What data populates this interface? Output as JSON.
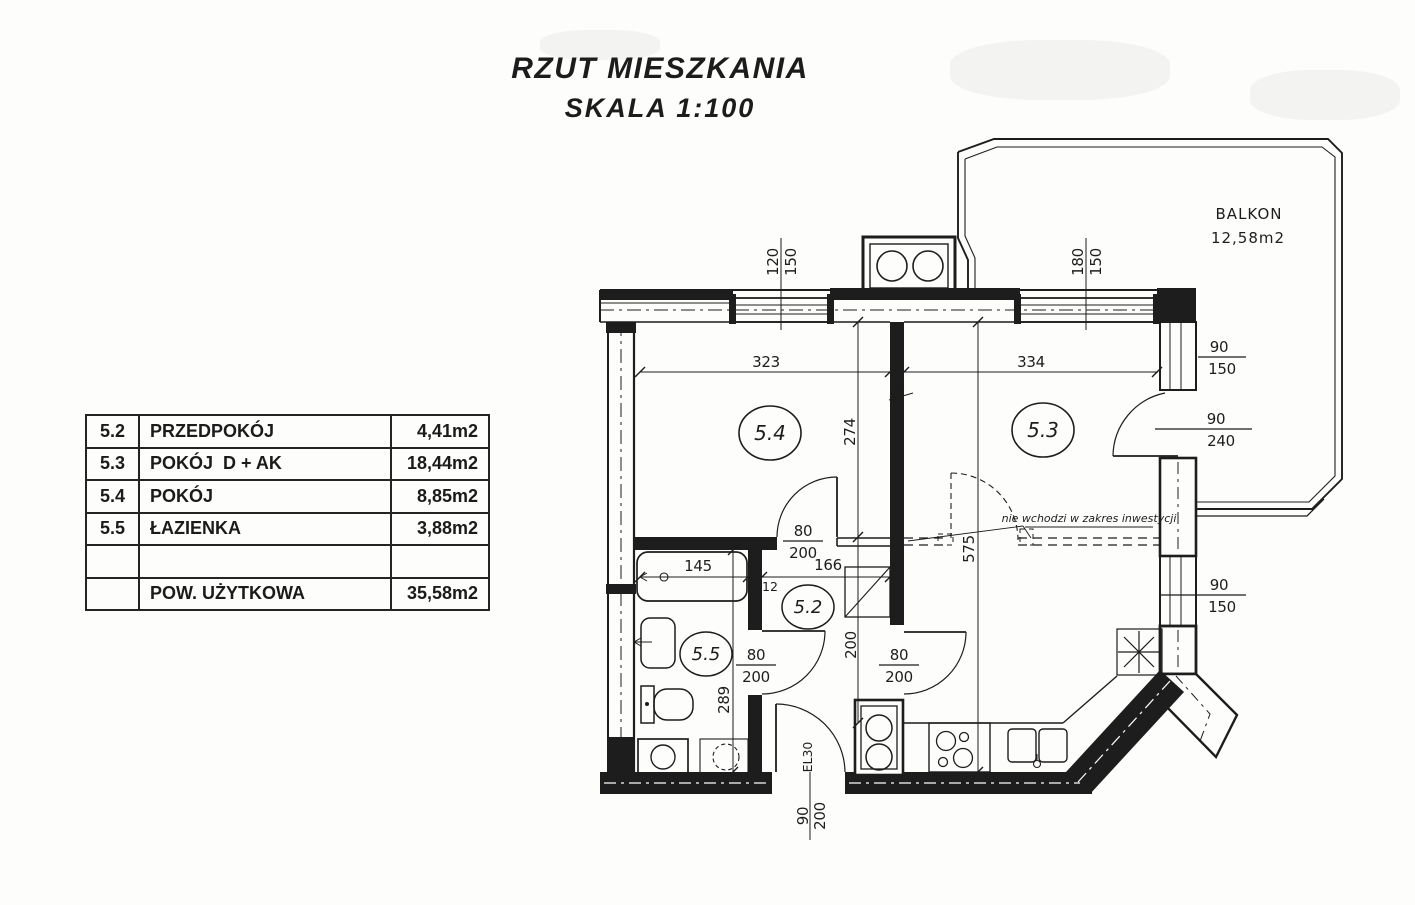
{
  "title": {
    "line1": "RZUT MIESZKANIA",
    "line2": "SKALA 1:100"
  },
  "legend_table": {
    "rows": [
      {
        "no": "5.2",
        "name": "PRZEDPOKÓJ",
        "area": "4,41m2"
      },
      {
        "no": "5.3",
        "name": "POKÓJ  D + AK",
        "area": "18,44m2"
      },
      {
        "no": "5.4",
        "name": "POKÓJ",
        "area": "8,85m2"
      },
      {
        "no": "5.5",
        "name": "ŁAZIENKA",
        "area": "3,88m2"
      },
      {
        "no": "",
        "name": "",
        "area": ""
      },
      {
        "no": "",
        "name": "POW. UŻYTKOWA",
        "area": "35,58m2"
      }
    ]
  },
  "plan": {
    "balcony": {
      "label": "BALKON",
      "area": "12,58m2"
    },
    "rooms": {
      "r52": "5.2",
      "r53": "5.3",
      "r54": "5.4",
      "r55": "5.5"
    },
    "dims": {
      "win_top_left_w": "120",
      "win_top_left_h": "150",
      "win_top_right_w": "180",
      "win_top_right_h": "150",
      "win_right_top_w": "90",
      "win_right_top_h": "150",
      "balcony_door_w": "90",
      "balcony_door_h": "240",
      "win_right_bottom_w": "90",
      "win_right_bottom_h": "150",
      "room54_width": "323",
      "room53_width": "334",
      "room54_depth": "274",
      "wall_thickness": "8",
      "room53_depth": "575",
      "hall_width": "166",
      "tub_length": "145",
      "wall12": "12",
      "bath_depth": "289",
      "kitchen_depth": "200",
      "door_a_w": "80",
      "door_a_h": "200",
      "door_b_w": "80",
      "door_b_h": "200",
      "door_c_w": "80",
      "door_c_h": "200",
      "entry_w": "90",
      "entry_h": "200",
      "entry_label": "EL30"
    },
    "note": "nie wchodzi w zakres inwestycji"
  }
}
